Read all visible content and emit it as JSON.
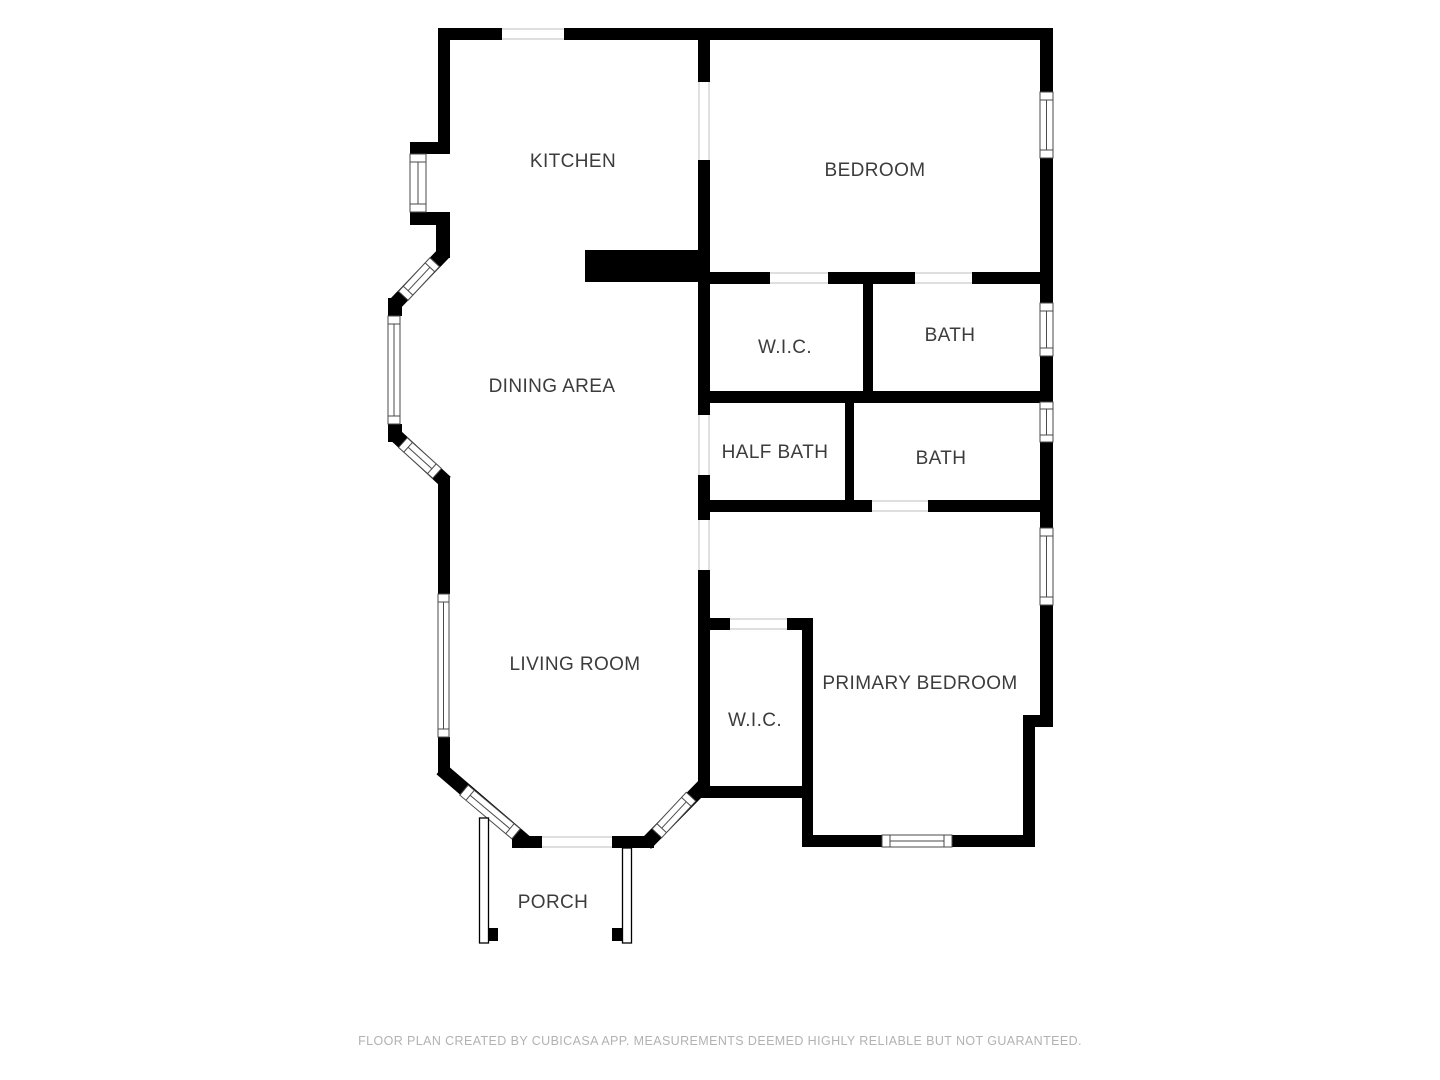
{
  "rooms": {
    "kitchen": {
      "label": "KITCHEN"
    },
    "bedroom": {
      "label": "BEDROOM"
    },
    "dining_area": {
      "label": "DINING AREA"
    },
    "wic_hall": {
      "label": "W.I.C."
    },
    "bath_upper": {
      "label": "BATH"
    },
    "half_bath": {
      "label": "HALF BATH"
    },
    "bath_lower": {
      "label": "BATH"
    },
    "living_room": {
      "label": "LIVING ROOM"
    },
    "wic_primary": {
      "label": "W.I.C."
    },
    "primary_bedroom": {
      "label": "PRIMARY BEDROOM"
    },
    "porch": {
      "label": "PORCH"
    }
  },
  "footer": {
    "disclaimer": "FLOOR PLAN CREATED BY CUBICASA APP. MEASUREMENTS DEEMED HIGHLY RELIABLE BUT NOT GUARANTEED."
  },
  "colors": {
    "wall": "#000000",
    "label_text": "#3c3c3c",
    "footer_text": "#b2b2b2",
    "background": "#ffffff",
    "window_frame": "#4a4a4a",
    "threshold": "#cccccc"
  }
}
